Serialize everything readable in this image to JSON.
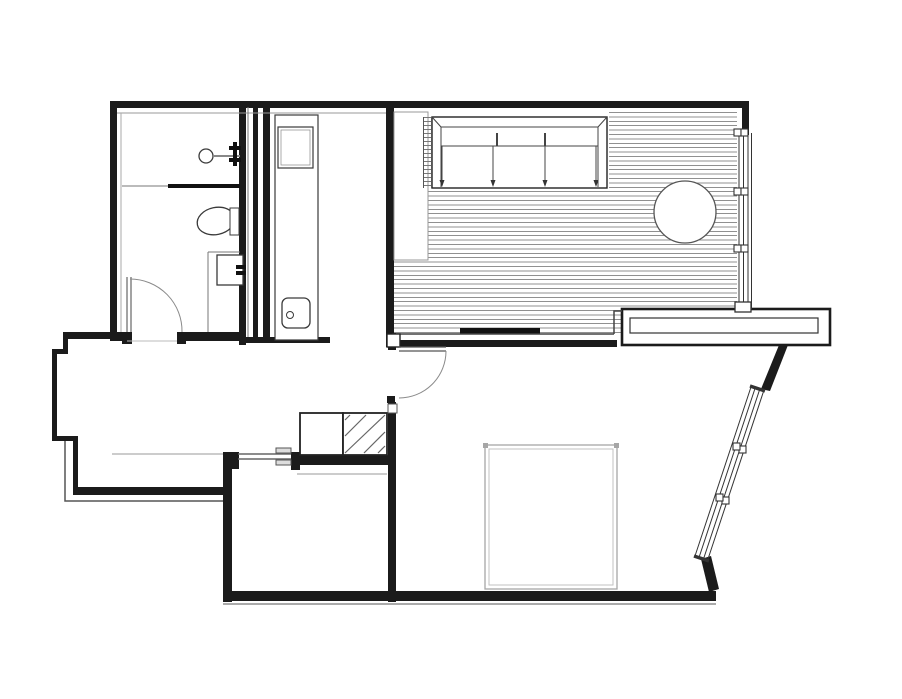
{
  "document": {
    "type": "architectural floor plan",
    "description": "line drawing of a one-bedroom apartment, no text labels visible",
    "text_labels": []
  },
  "palette": {
    "background": "#ffffff",
    "wall": "#1b1b1b",
    "fixture_stroke": "#3a3a3a",
    "window_stroke": "#333333",
    "door_stroke": "#8a8a8a",
    "deck_stripe": "#909090",
    "furniture_gray": "#a6a6a6",
    "accent_black": "#111111"
  },
  "rooms": [
    {
      "id": "bathroom",
      "features": [
        "shower-head",
        "shower-screen",
        "toilet",
        "washbasin",
        "inward-door-swing"
      ]
    },
    {
      "id": "utility-column",
      "features": [
        "appliance-box",
        "small-sink-with-drain"
      ]
    },
    {
      "id": "hallway",
      "features": [
        "entry-step-line",
        "kitchen-unit-plain",
        "kitchen-unit-hatched"
      ]
    },
    {
      "id": "deck-room",
      "features": [
        "striped-decking",
        "wardrobe-with-arrows",
        "ladder-strip",
        "tall-cabinet-column",
        "round-table",
        "threshold-bar"
      ]
    },
    {
      "id": "bedroom",
      "features": [
        "bed-outline-gray",
        "door-swing"
      ]
    },
    {
      "id": "storage-room",
      "features": [
        "hinged-door"
      ]
    }
  ],
  "openings": {
    "doors": [
      "bathroom-door",
      "bedroom-door",
      "storage-room-door"
    ],
    "windows": [
      "north-window-strip",
      "southeast-angled-window"
    ],
    "other": [
      "parapet-planter-band"
    ]
  },
  "hatching": {
    "deck_stripe_spacing_px": 4.4,
    "ladder_tick_spacing_px": 4,
    "diagonal_hatch_location": "kitchen-unit-hatched"
  }
}
